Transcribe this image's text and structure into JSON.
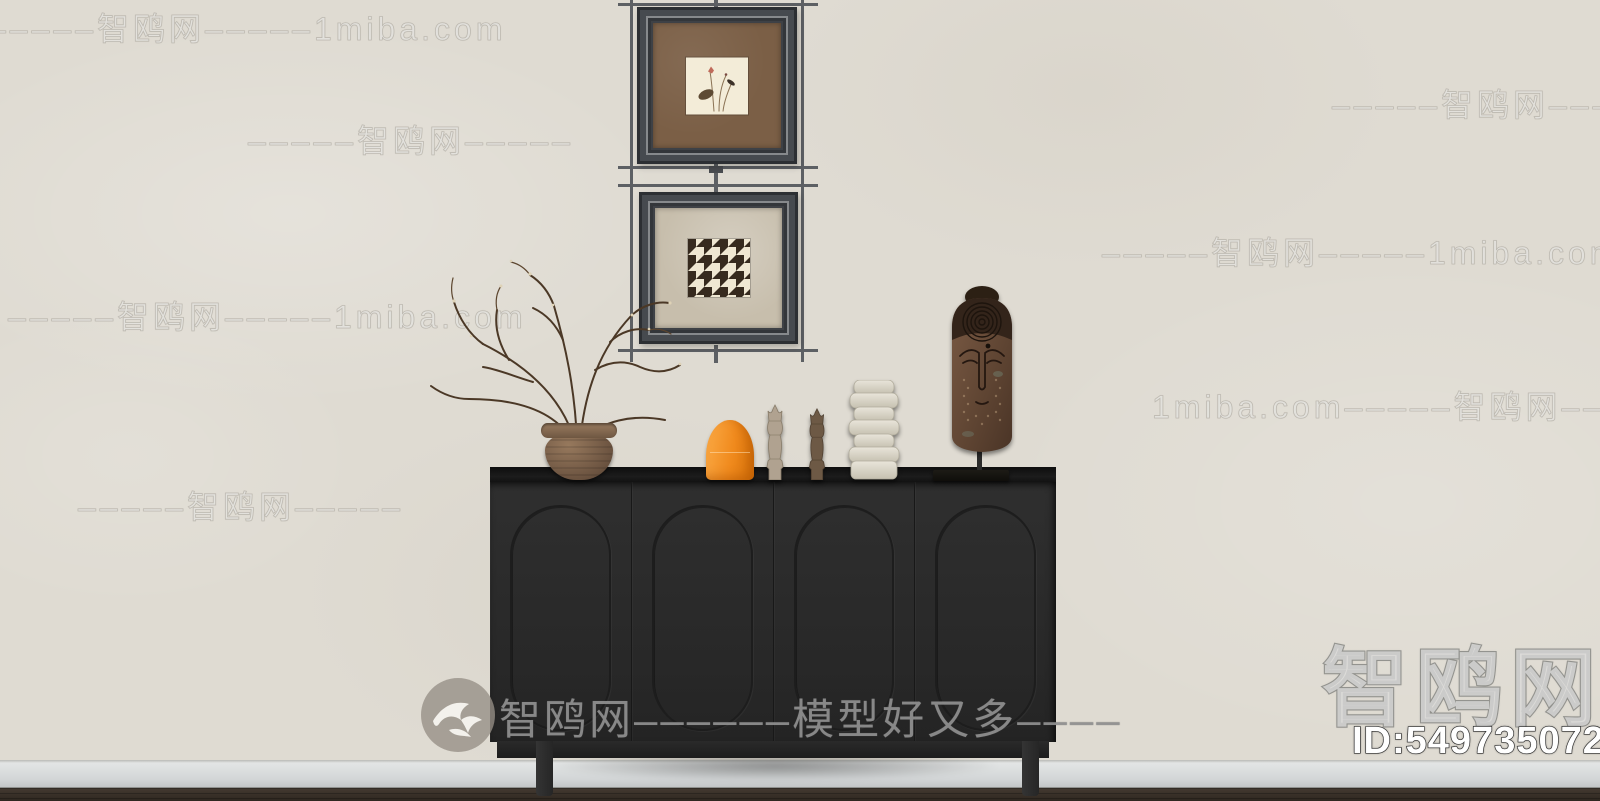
{
  "watermarks": {
    "rows": [
      {
        "text": "–––––智鸥网–––––1miba.com"
      },
      {
        "text": "–––––智鸥网–––––"
      },
      {
        "text": "–––––智鸥网–––––"
      },
      {
        "text": "–––––智鸥网–––––1miba.com"
      },
      {
        "text": "–––––智鸥网–––––1miba.com"
      },
      {
        "text": "1miba.com–––––智鸥网–––––"
      },
      {
        "text": "–––––智鸥网–––––"
      }
    ],
    "center_text": "智鸥网––––––模型好又多––––",
    "corner_logo": "智鸥网",
    "corner_id": "ID:549735072"
  },
  "colors": {
    "wall": "#dfdbd2",
    "cabinet_black": "#2b2b2b",
    "accent_orange": "#f08a1d",
    "baseboard_gray": "#d3d6d7",
    "floor_brown": "#372f28",
    "frame_dark": "#3e4146",
    "matte_brown": "#7b5f46",
    "matte_beige": "#c7beac"
  }
}
